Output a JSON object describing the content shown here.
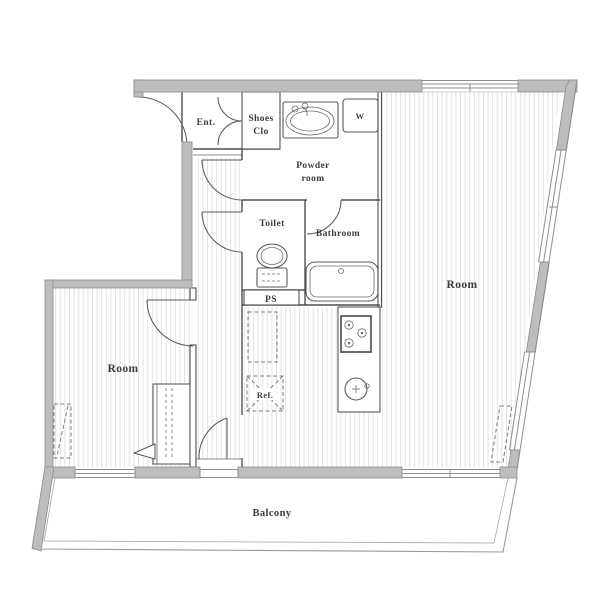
{
  "diagram_type": "apartment-floor-plan",
  "labels": {
    "entrance": "Ent.",
    "shoes_closet": [
      "Shoes",
      "Clo"
    ],
    "powder_room": [
      "Powder",
      "room"
    ],
    "washing_machine": "W",
    "toilet": "Toilet",
    "bathroom": "Bathroom",
    "pipe_space": "PS",
    "refrigerator": "Ref.",
    "main_room": "Room",
    "second_room": "Room",
    "balcony": "Balcony"
  },
  "colors": {
    "background": "#ffffff",
    "wall_fill": "#bdbdbd",
    "wall_outline": "#8c8c8c",
    "interior_line": "#4f4f4f",
    "floor_hatch": "#e2e2e2",
    "text": "#3d3d3d"
  }
}
